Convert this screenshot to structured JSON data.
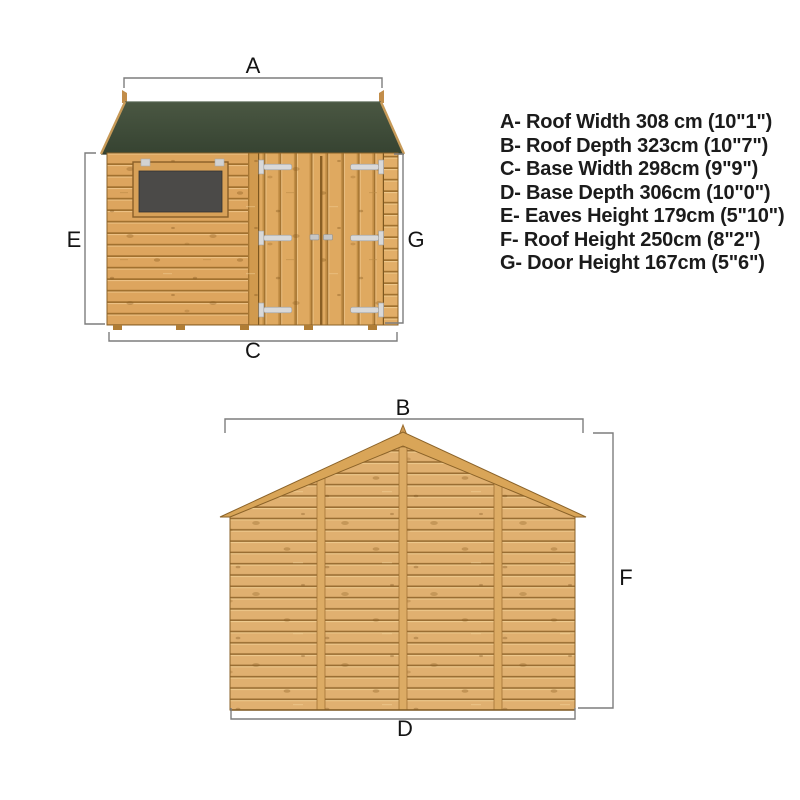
{
  "legend": {
    "items": [
      "A- Roof Width 308 cm (10\"1\")",
      "B- Roof Depth 323cm (10\"7\")",
      "C- Base Width 298cm (9\"9\")",
      "D- Base Depth 306cm (10\"0\")",
      "E- Eaves Height 179cm (5\"10\")",
      "F- Roof Height 250cm (8\"2\")",
      "G- Door Height 167cm (5\"6\")"
    ]
  },
  "front_view": {
    "dim_labels": {
      "top": "A",
      "left": "E",
      "right": "G",
      "bottom": "C"
    }
  },
  "side_view": {
    "dim_labels": {
      "top": "B",
      "right": "F",
      "bottom": "D"
    }
  },
  "colors": {
    "roof_green": "#3f4c39",
    "wood": "#dca55f",
    "wood_light": "#e0b070",
    "plank_gap": "#9c6f33",
    "window_glass": "#4b4a48",
    "hinge_metal": "#d6d6d6",
    "dimension_line": "#7d7d7d",
    "text": "#1b1b1b",
    "background": "#ffffff"
  }
}
